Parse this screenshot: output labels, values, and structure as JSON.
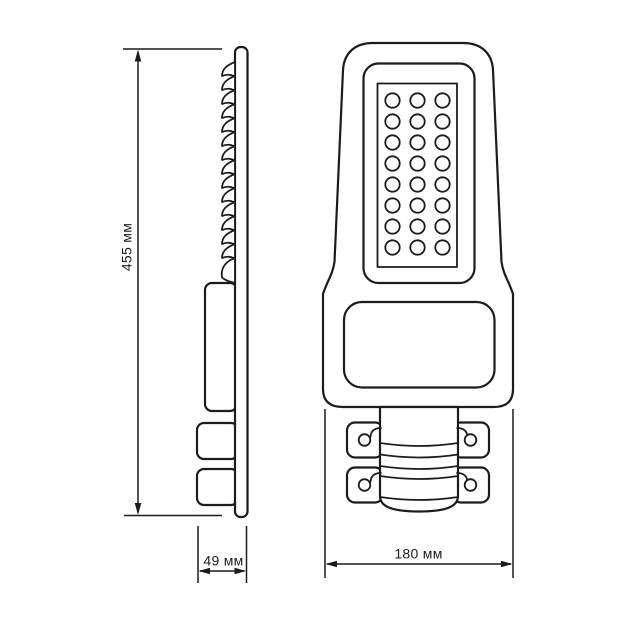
{
  "colors": {
    "line": "#1c1c1c",
    "background": "#ffffff"
  },
  "drawing": {
    "description": "LED street light dimensional drawing with side profile and front view",
    "dimensions": {
      "height_label": "455 мм",
      "depth_label": "49 мм",
      "width_label": "180 мм"
    },
    "led_grid": {
      "rows": 8,
      "cols": 3
    },
    "heatsink_fin_count": 15,
    "bolt_hole_count": 4
  }
}
